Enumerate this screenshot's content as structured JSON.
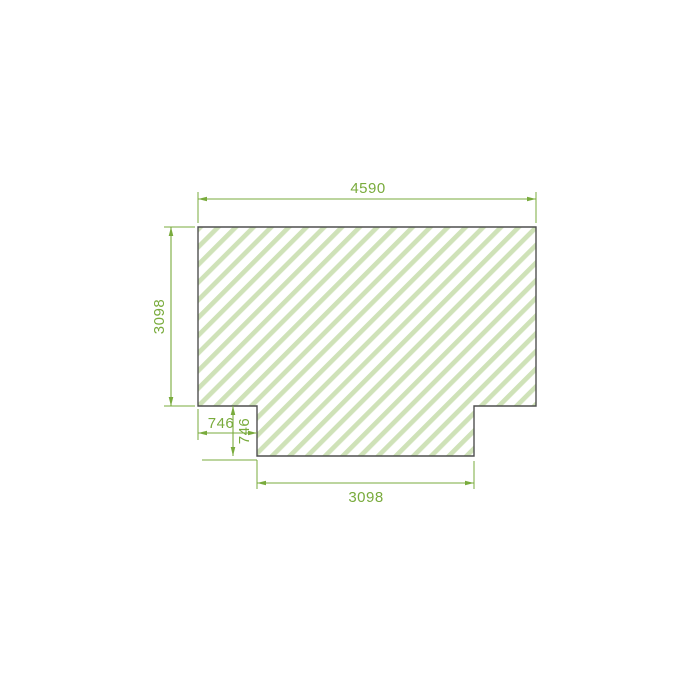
{
  "drawing": {
    "kind": "technical-panel-drawing",
    "shape_description": "rectangular panel with bottom tab, diagonal hatch fill",
    "dimensions": [
      {
        "id": "top-width",
        "value": "4590",
        "orientation": "horizontal",
        "position": "top"
      },
      {
        "id": "left-height",
        "value": "3098",
        "orientation": "vertical",
        "position": "left"
      },
      {
        "id": "notch-width",
        "value": "746",
        "orientation": "horizontal",
        "position": "bottom-left"
      },
      {
        "id": "notch-depth",
        "value": "746",
        "orientation": "vertical",
        "position": "bottom-left"
      },
      {
        "id": "tab-width",
        "value": "3098",
        "orientation": "horizontal",
        "position": "bottom"
      }
    ],
    "colors": {
      "dimension_green": "#79ab3c",
      "hatch_stripe_green": "#cfe2b8",
      "outline_gray": "#4f4f4f",
      "background": "#ffffff"
    }
  }
}
